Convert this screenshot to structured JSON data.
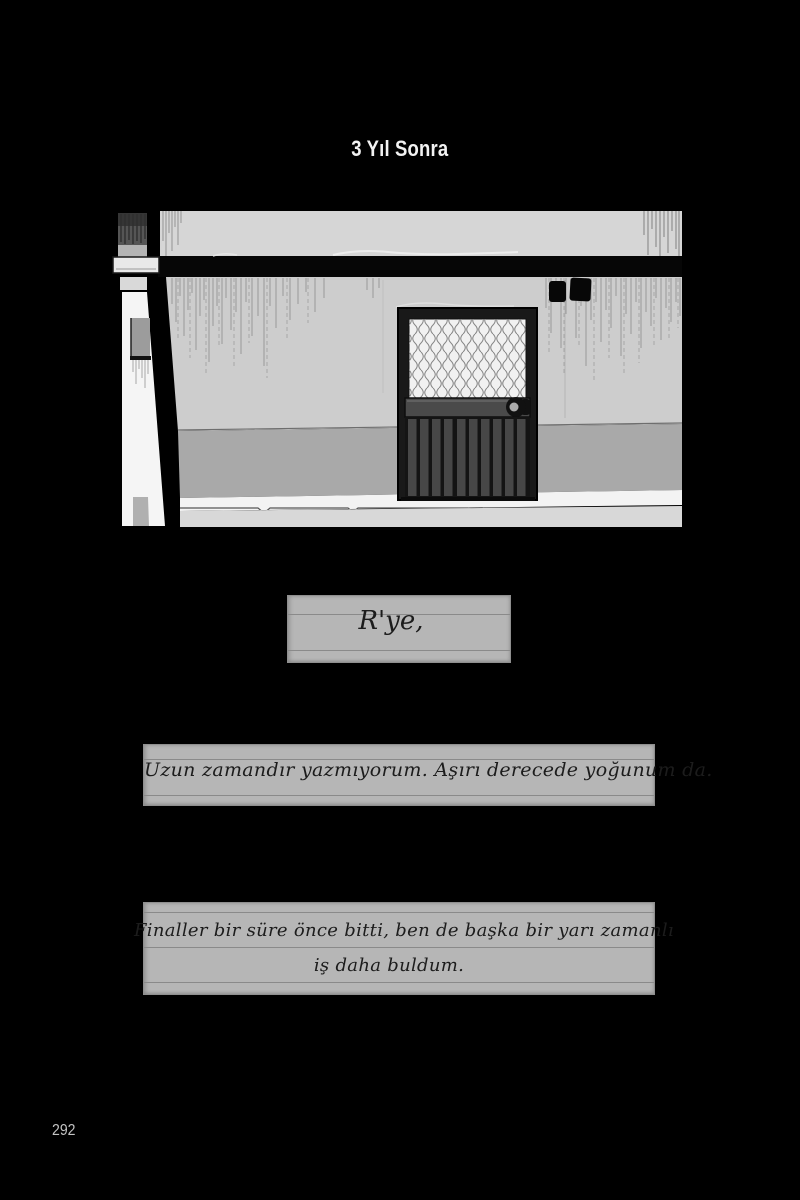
{
  "page": {
    "title": "3 Yıl Sonra",
    "page_number": "292"
  },
  "notes": [
    {
      "lines": [
        "R'ye,"
      ]
    },
    {
      "lines": [
        "Uzun zamandır yazmıyorum. Aşırı derecede yoğunum da."
      ]
    },
    {
      "lines": [
        "Finaller bir süre önce bitti, ben de başka bir yarı zamanlı",
        "iş daha buldum."
      ]
    }
  ],
  "colors": {
    "background": "#000000",
    "title_text": "#f2f2f2",
    "note_paper": "#b6b6b6",
    "note_rule": "#8a8a8a",
    "handwriting_ink": "#1c1c1c",
    "page_number_text": "#c3c3c3",
    "wall_upper": "#d6d6d6",
    "wall_main": "#cdcdcd",
    "wall_lower": "#a9a9a9",
    "sidewalk": "#d8d8d8",
    "door_dark": "#191919"
  }
}
